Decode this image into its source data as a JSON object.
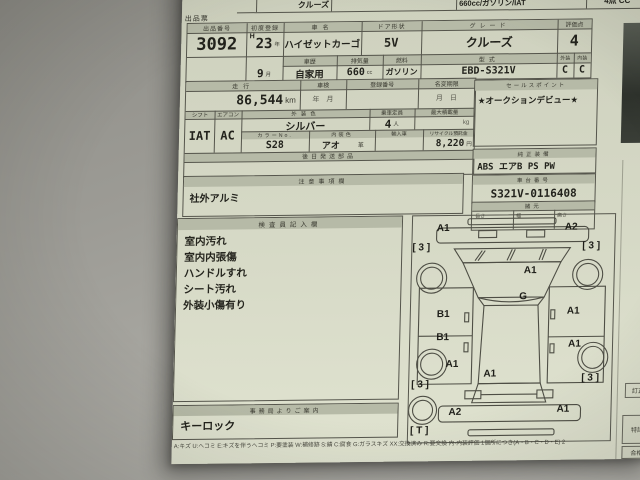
{
  "sheet": {
    "title": "出品票"
  },
  "stack_row": {
    "grade": "クルーズ",
    "spec": "660cc/ガソリン/IAT",
    "score": "4点 CC"
  },
  "header": {
    "lot_label": "出品番号",
    "lot_no": "3092",
    "first_reg_label": "初度登録",
    "era": "H",
    "reg_year": "23",
    "reg_month": "9",
    "name_label": "車名",
    "name": "ハイゼットカーゴ",
    "door_label": "ドア形状",
    "door": "5V",
    "history_label": "車歴",
    "history": "自家用",
    "disp_label": "排気量",
    "displacement": "660",
    "fuel_label": "燃料",
    "fuel": "ガソリン",
    "grade_label": "グレード",
    "grade": "クルーズ",
    "model_label": "型式",
    "model": "EBD-S321V",
    "score_label": "評価点",
    "score": "4",
    "ext_label": "外装",
    "int_label": "内装",
    "ext_grade": "C",
    "int_grade": "C"
  },
  "details": {
    "mileage_label": "走行",
    "mileage": "86,544",
    "shaken_label": "車検",
    "shaken_value": "年　月",
    "regno_label": "登録番号",
    "namechange_label": "名変期限",
    "namechange_value": "月　日",
    "shift_label": "シフト",
    "shift": "IAT",
    "aircon_label": "エアコン",
    "aircon": "AC",
    "extcolor_label": "外装色",
    "ext_color": "シルバー",
    "capacity_label": "乗車定員",
    "capacity": "4",
    "payload_label": "最大積載量",
    "colorno_label": "カラーNo.",
    "color_no": "S28",
    "intcolor_label": "内装色",
    "int_color": "アオ",
    "leather_mark": "革",
    "import_label": "輸入車",
    "recycle_label": "リサイクル預託金",
    "recycle_fee": "8,220",
    "latership_label": "後日発送部品"
  },
  "units": {
    "year": "年",
    "month": "月",
    "cc": "cc",
    "km": "km",
    "person": "人",
    "kg": "kg",
    "yen": "円"
  },
  "sales": {
    "label": "セールスポイント",
    "content": "★オークションデビュー★"
  },
  "equipment": {
    "label": "純正装備",
    "content": "ABS エアB PS PW"
  },
  "chassis": {
    "label": "車台番号",
    "no": "S321V-0116408"
  },
  "spec": {
    "label": "諸元",
    "length_label": "長さ",
    "width_label": "幅",
    "height_label": "高さ"
  },
  "notes": {
    "label": "注意事項欄",
    "content": "社外アルミ"
  },
  "inspector": {
    "label": "検査員記入欄",
    "lines": [
      "室内汚れ",
      "室内内張傷",
      "ハンドルすれ",
      "シート汚れ",
      "外装小傷有り"
    ]
  },
  "office": {
    "label": "事務局よりご案内",
    "content": "キーロック"
  },
  "legend": "A:キズ U:ヘコミ E:キズを伴うヘコミ P:要塗装 W:補修跡 S:錆 C:腐食 G:ガラスキズ XX:交換済み R:要交換 内-内装評価 1個所につき(A・B・C・D・E) 2",
  "edge_boxes": {
    "correction": "訂正",
    "special": "特記",
    "pass": "合格",
    "recheck": "再検"
  },
  "colors": {
    "sheet": "#d3d6c3",
    "label_fill": "#b6baa7",
    "ink": "#22221c",
    "border": "#55554c",
    "desk": "#9b9a94"
  },
  "diagram": {
    "marks": [
      {
        "label": "A1",
        "x": 24,
        "y": 7
      },
      {
        "label": "A2",
        "x": 152,
        "y": 7
      },
      {
        "label": "[ 3 ]",
        "x": 0,
        "y": 26
      },
      {
        "label": "[ 3 ]",
        "x": 170,
        "y": 26
      },
      {
        "label": "A1",
        "x": 112,
        "y": 50
      },
      {
        "label": "G",
        "x": 108,
        "y": 76
      },
      {
        "label": "B1",
        "x": 26,
        "y": 93
      },
      {
        "label": "A1",
        "x": 156,
        "y": 91
      },
      {
        "label": "B1",
        "x": 26,
        "y": 116
      },
      {
        "label": "A1",
        "x": 158,
        "y": 124
      },
      {
        "label": "A1",
        "x": 36,
        "y": 143
      },
      {
        "label": "A1",
        "x": 74,
        "y": 153
      },
      {
        "label": "[ 3 ]",
        "x": 2,
        "y": 163
      },
      {
        "label": "[ 3 ]",
        "x": 172,
        "y": 158
      },
      {
        "label": "A2",
        "x": 40,
        "y": 191
      },
      {
        "label": "A1",
        "x": 148,
        "y": 189
      },
      {
        "label": "[ T ]",
        "x": 2,
        "y": 209
      }
    ]
  }
}
